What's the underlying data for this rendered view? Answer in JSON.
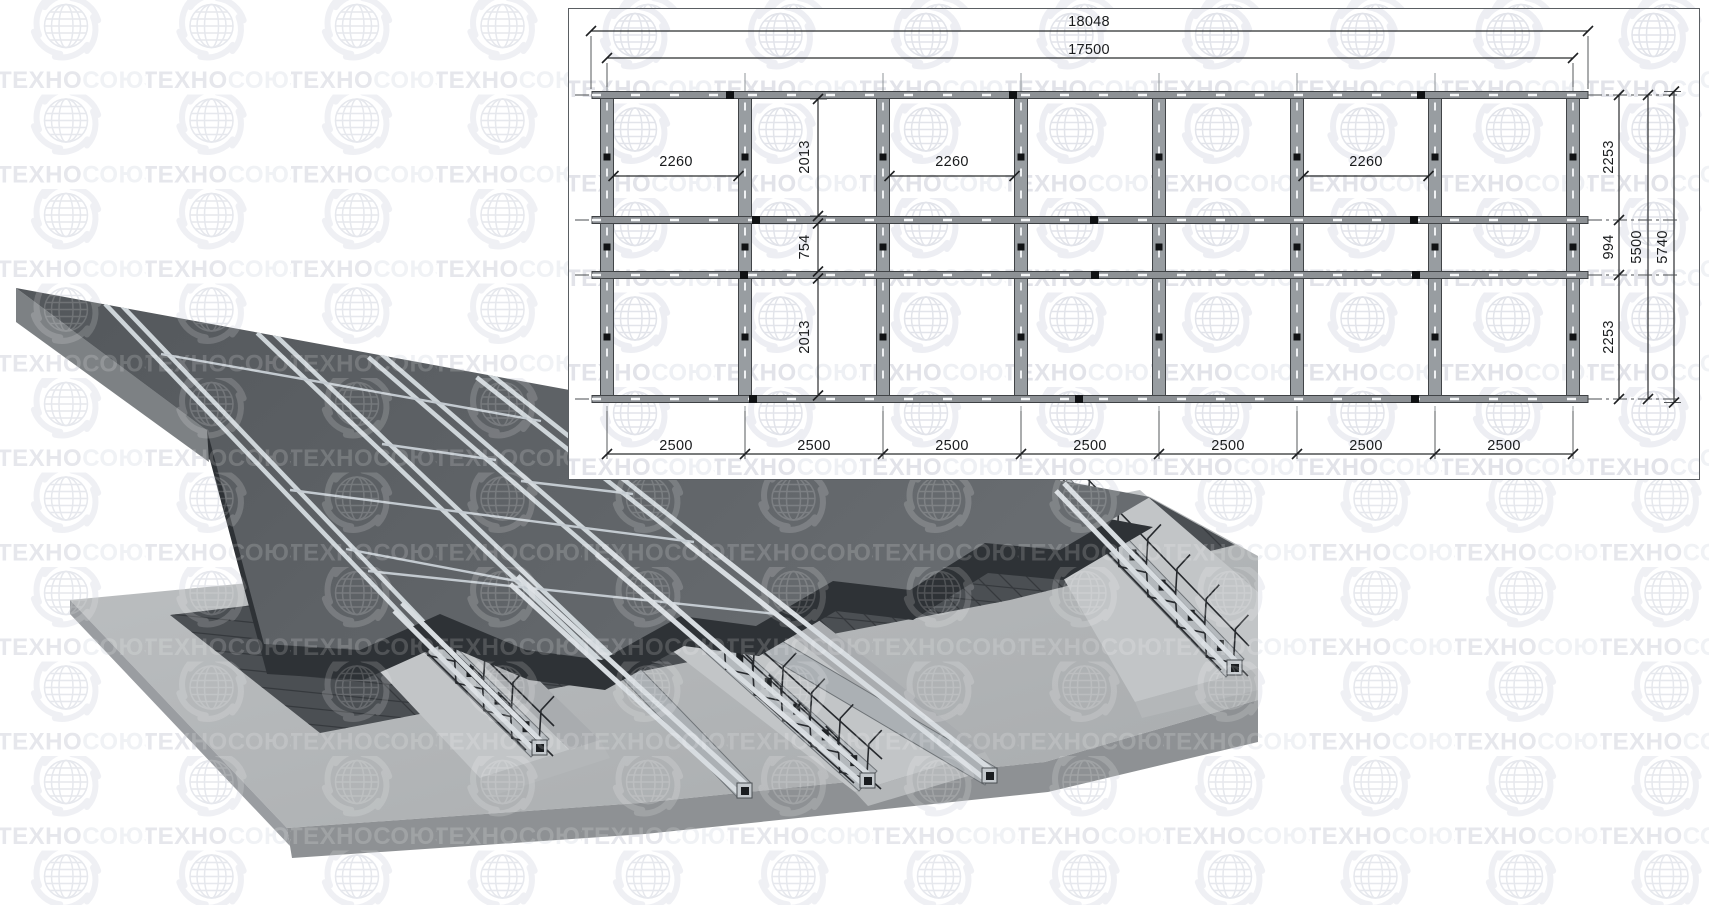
{
  "watermark": {
    "brand_full": "ТЕХНОСОЮЗ",
    "brand_prefix": "ТЕХНО",
    "brand_suffix": "СОЮЗ",
    "registered_mark": "®"
  },
  "plan": {
    "overall_width": "18048",
    "rail_length": "17500",
    "bay_widths": [
      "2500",
      "2500",
      "2500",
      "2500",
      "2500",
      "2500",
      "2500"
    ],
    "post_spacings": [
      "2260",
      "2260",
      "2260"
    ],
    "left_band_dims": [
      "2013",
      "754",
      "2013"
    ],
    "right_band_dims": [
      "2253",
      "994",
      "2253"
    ],
    "rails_extent": "5500",
    "overall_depth": "5740"
  },
  "colors": {
    "slab_dark": "#575b5f",
    "base_light": "#b5b8ba",
    "rail_light": "#d6dbdf",
    "mesh_dark": "#3b3e42",
    "watermark_gray": "#e7e8ee"
  }
}
